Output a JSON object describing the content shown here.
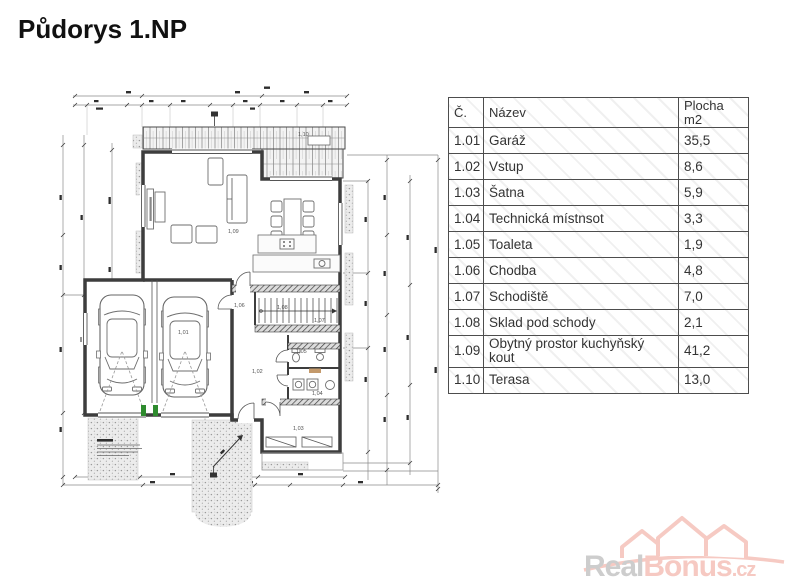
{
  "page": {
    "title": "Půdorys 1.NP"
  },
  "table": {
    "col_number": "Č.",
    "col_name": "Název",
    "col_area_line1": "Plocha",
    "col_area_line2": "m2",
    "rows": [
      {
        "number": "1.01",
        "name": "Garáž",
        "area": "35,5"
      },
      {
        "number": "1.02",
        "name": "Vstup",
        "area": "8,6"
      },
      {
        "number": "1.03",
        "name": "Šatna",
        "area": "5,9"
      },
      {
        "number": "1.04",
        "name": "Technická místnsot",
        "area": "3,3"
      },
      {
        "number": "1.05",
        "name": "Toaleta",
        "area": "1,9"
      },
      {
        "number": "1.06",
        "name": "Chodba",
        "area": "4,8"
      },
      {
        "number": "1.07",
        "name": "Schodiště",
        "area": "7,0"
      },
      {
        "number": "1.08",
        "name": "Sklad pod schody",
        "area": "2,1"
      },
      {
        "number": "1.09",
        "name": "Obytný prostor kuchyňský kout",
        "area": "41,2"
      },
      {
        "number": "1.10",
        "name": "Terasa",
        "area": "13,0"
      }
    ]
  },
  "plan": {
    "labels": {
      "garaz": "1,01",
      "vstup": "1,02",
      "satna": "1,03",
      "technicka": "1,04",
      "toaleta": "1,05",
      "chodba": "1,06",
      "schodiste": "1,07",
      "sklad": "1,08",
      "obytny": "1,09",
      "terasa": "1,10"
    }
  },
  "logo": {
    "part1": "Real",
    "part2": "Bonus",
    "tld": ".cz"
  },
  "colors": {
    "logo_gray": "#cdcdcd",
    "logo_pink": "#f6c9c2",
    "threshold_green": "#2e8b2e"
  }
}
